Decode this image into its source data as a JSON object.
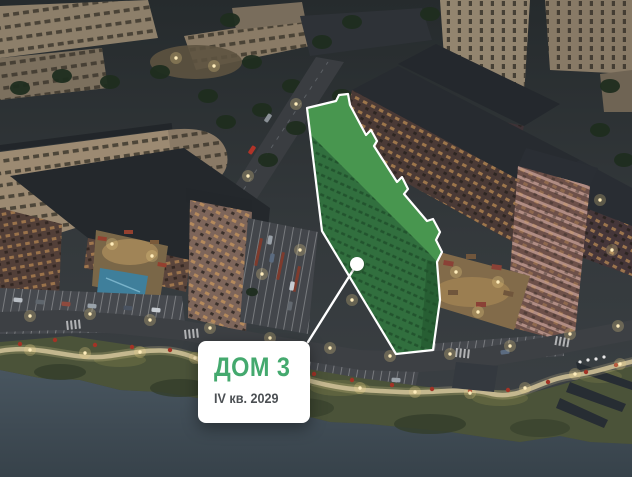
{
  "masterplan": {
    "selected_building": {
      "name": "ДОМ 3",
      "completion_quarter": "IV кв. 2029"
    },
    "colors": {
      "accent_green": "#44A96E",
      "subtitle_text": "#4C5054",
      "card_background": "#FFFFFF",
      "highlight_fill": "#2F7A3F",
      "highlight_roof": "#48964F",
      "highlight_outline": "#FFFFFF",
      "marker_dot": "#FFFFFF",
      "water": "#41505A"
    }
  }
}
